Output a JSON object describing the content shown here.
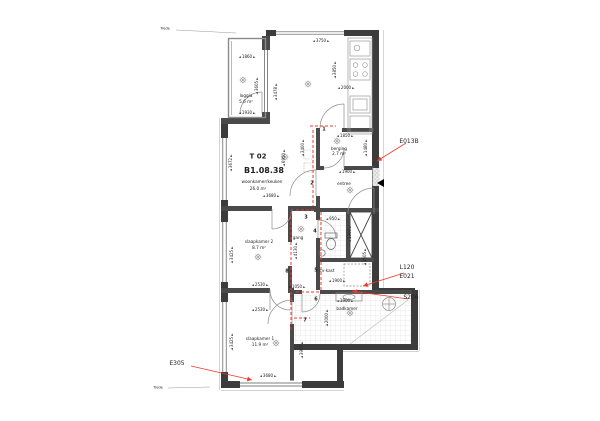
{
  "unit": {
    "id": "T 02",
    "number": "B1.08.38",
    "function": "woonkamer/keuken",
    "area": "26.0 m²"
  },
  "rooms": {
    "loggia": {
      "name": "loggia",
      "area": "5.6 m²"
    },
    "berging": {
      "name": "berging",
      "area": "2.7 m²"
    },
    "entree": {
      "name": "entree"
    },
    "gang": {
      "name": "gang"
    },
    "cv_kast": {
      "name": "cv-kast"
    },
    "slaapkamer2": {
      "name": "slaapkamer 2",
      "area": "8.7 m²"
    },
    "slaapkamer1": {
      "name": "slaapkamer 1",
      "area": "11.9 m²"
    },
    "badkamer": {
      "name": "badkamer"
    }
  },
  "dims": {
    "loggia_width": "1860",
    "loggia_width_lower": "1930",
    "loggia_height": "3605",
    "loggia_inner_height": "3478",
    "living_width_top": "3750",
    "living_width_bottom": "3680",
    "living_height": "6950",
    "living_height_left": "3672",
    "living_inner_height": "3400",
    "kitchen_width": "2000",
    "kitchen_height": "3850",
    "berging_width": "1850",
    "berging_height": "1480",
    "entree_width": "1900",
    "wc_width": "950",
    "wc_height": "1300",
    "shaft_height": "1505",
    "cv_width": "1900",
    "gang_width": "1050",
    "gang_height": "4130",
    "slaapkamer2_width": "2530",
    "slaapkamer2_height": "3425",
    "slaapkamer1_width": "2530",
    "slaapkamer1_height": "3425",
    "slaapkamer1_height_right": "3905",
    "slaapkamer1_width_bottom": "3680",
    "badkamer_width": "1900",
    "badkamer_height": "2000"
  },
  "annotations": {
    "top_right": "E013B",
    "mid_right_1": "L120",
    "mid_right_2": "E021",
    "right_lower": "S206",
    "bottom_left": "E305"
  },
  "route_markers": [
    "1",
    "2",
    "3",
    "4",
    "5",
    "6",
    "7",
    "8"
  ],
  "notes": {
    "trede": "Trede"
  },
  "colors": {
    "annotation_red": "#ee3b2d",
    "wall_dark": "#3c3c3c",
    "wall_light": "#8a8a8a"
  }
}
